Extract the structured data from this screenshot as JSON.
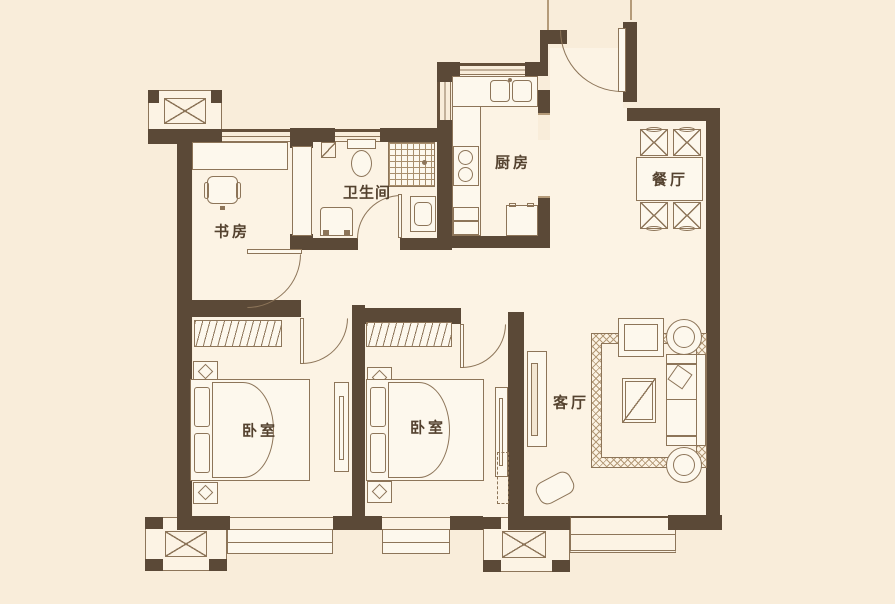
{
  "plan_title": "两室两厅一卫户型图",
  "colors": {
    "wall": "#5b4937",
    "furniture_line": "#8d7559",
    "background_outside": "#f9edda",
    "background_room": "#fcf3e4",
    "label_text": "#54422f"
  },
  "rooms": {
    "study": "书房",
    "bathroom": "卫生间",
    "kitchen": "厨房",
    "dining": "餐厅",
    "bedroom1": "卧室",
    "bedroom2": "卧室",
    "living": "客厅"
  }
}
